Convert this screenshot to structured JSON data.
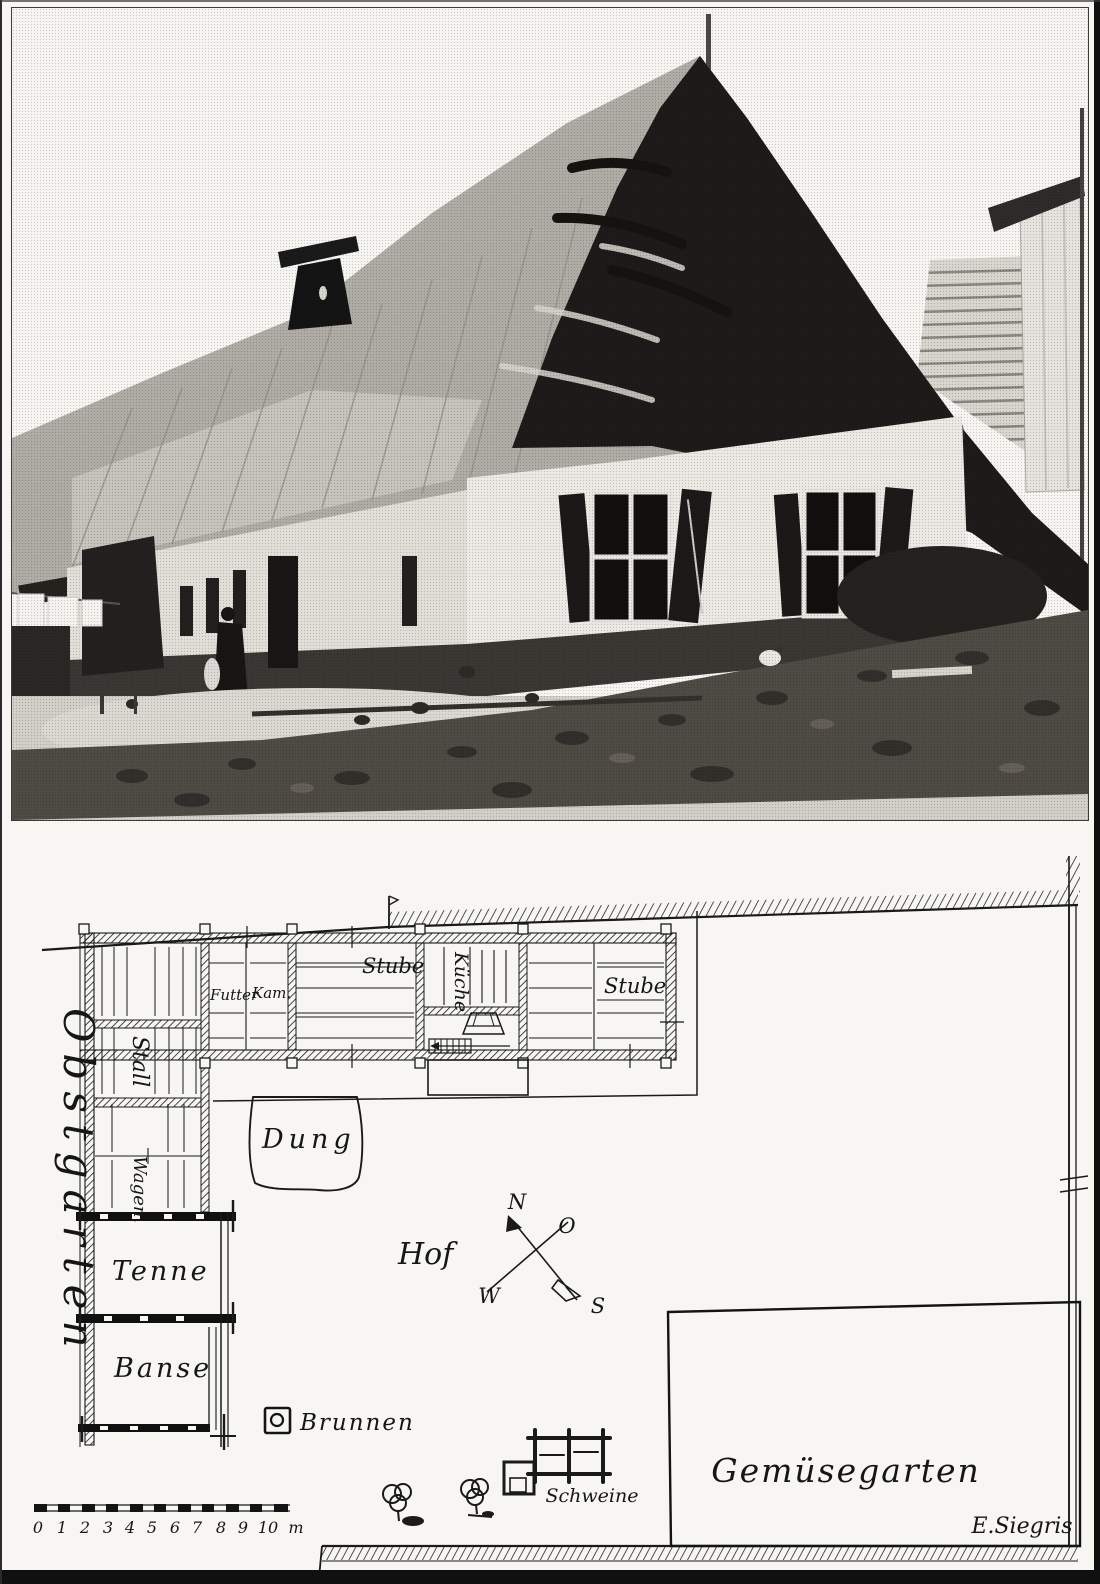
{
  "plan": {
    "areas": {
      "obstgarten": "Obstgarten",
      "gemuesegarten": "Gemüsegarten",
      "hof": "Hof",
      "dung": "Dung"
    },
    "rooms": {
      "futter": "Futter",
      "kam": "Kam.",
      "stube_west": "Stube",
      "kueche": "Küche",
      "stube_east": "Stube",
      "stall": "Stall",
      "wagen": "Wagen.",
      "tenne": "Tenne",
      "banse": "Banse"
    },
    "features": {
      "brunnen": "Brunnen",
      "schweine": "Schweine"
    },
    "compass": {
      "north": "N",
      "east": "O",
      "south": "S",
      "west": "W"
    },
    "scale_bar": {
      "ticks": [
        "0",
        "1",
        "2",
        "3",
        "4",
        "5",
        "6",
        "7",
        "8",
        "9",
        "10"
      ],
      "unit": "m"
    },
    "signature": "E.Siegris"
  }
}
